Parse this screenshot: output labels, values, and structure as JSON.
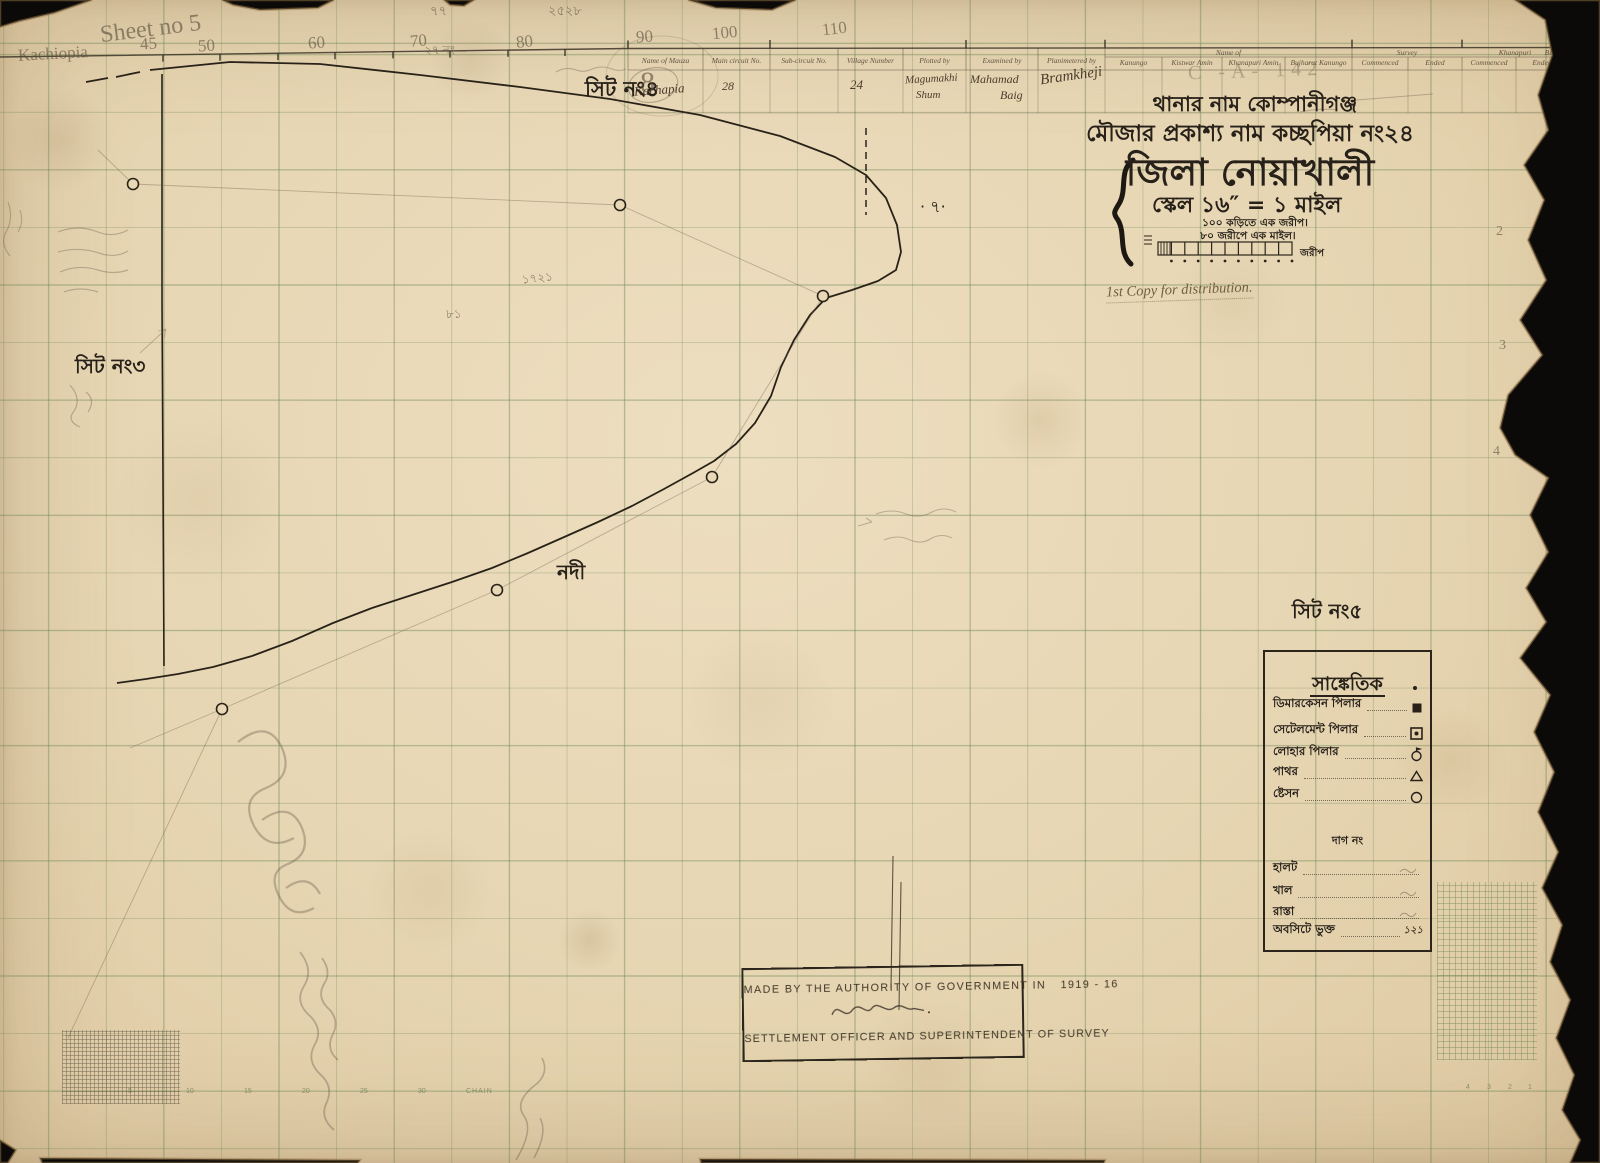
{
  "title_block": {
    "line1": "থানার নাম কোম্পানীগঞ্জ",
    "line2": "মৌজার প্রকাশ্য নাম কচ্ছপিয়া নং২৪",
    "line3": "জিলা নোয়াখালী",
    "line4": "স্কেল ১৬″ = ১ মাইল",
    "scale_note1": "১০০ কড়িতে এক জরীপ।",
    "scale_note2": "৮০ জরীপে এক মাইল।",
    "scale_bar_right_label": "জরীপ",
    "distribution_note": "1st Copy for distribution."
  },
  "header_form": {
    "groups": [
      "Name of",
      "Survey",
      "Khanapuri",
      "Bujharat"
    ],
    "columns": [
      "Name of Mauza",
      "Main circuit No.",
      "Sub-circuit No.",
      "Village Number",
      "Plotted by",
      "Examined by",
      "Planimetered by",
      "Kanungo",
      "Kistwar Amin",
      "Khanapuri Amin",
      "Bujharat Kanungo",
      "Commenced",
      "Ended",
      "Commenced",
      "Ended",
      "Commenced",
      "Ended"
    ],
    "entries": {
      "name_of_mauza": "Kachapia",
      "main_circuit_no": "28",
      "village_number": "24",
      "plotted_by_line1": "Magumakhi",
      "plotted_by_line2": "Shum",
      "examined_by_line1": "Mahamad",
      "examined_by_line2": "Baig",
      "planimetered_by": "Bramkheji"
    }
  },
  "map_labels": {
    "sheet4": "সিট নং৪",
    "sheet3": "সিট নং৩",
    "sheet5": "সিট নং৫",
    "river": "নদী",
    "mark7": "· ৭·"
  },
  "pencil_annotations": {
    "top_left_line1": "Sheet no 5",
    "top_left_line2": "Kachiopia",
    "grid_numbers": [
      "45",
      "50",
      "60",
      "70",
      "80",
      "90",
      "100",
      "110"
    ],
    "top_center_small": "২৫২৮",
    "top_center_mark": "৭৭",
    "note_27": "২৭ নং—",
    "catalog_mark": "C  -A- 142",
    "num_1721": "১৭২১",
    "num_81": "৮১",
    "sheet4_circled_number": "8",
    "edge_marks": [
      "2",
      "3",
      "4"
    ]
  },
  "legend": {
    "title": "সাঙ্কেতিক",
    "items": [
      {
        "label": "ডিমারকেসন পিলার",
        "symbol": "filled-square"
      },
      {
        "label": "সেটেলমেন্ট পিলার",
        "symbol": "square-with-dot"
      },
      {
        "label": "লোহার পিলার",
        "symbol": "circle-with-flag"
      },
      {
        "label": "পাথর",
        "symbol": "triangle"
      },
      {
        "label": "ষ্টেসন",
        "symbol": "circle"
      }
    ],
    "sub_header": "দাগ নং",
    "line_items": [
      {
        "label": "হালট"
      },
      {
        "label": "খাল"
      },
      {
        "label": "রাস্তা"
      },
      {
        "label": "অবসিটে ভুক্ত",
        "note": "১২১"
      }
    ]
  },
  "stamp": {
    "line1": "MADE BY THE AUTHORITY OF GOVERNMENT IN",
    "year": "1919 - 16",
    "line2": "SETTLEMENT OFFICER AND SUPERINTENDENT OF SURVEY"
  },
  "bottom_ruler": {
    "numbers": [
      "5",
      "10",
      "15",
      "20",
      "25",
      "30"
    ],
    "label": "CHAIN",
    "corner_numbers": [
      "4",
      "3",
      "2",
      "1"
    ]
  }
}
